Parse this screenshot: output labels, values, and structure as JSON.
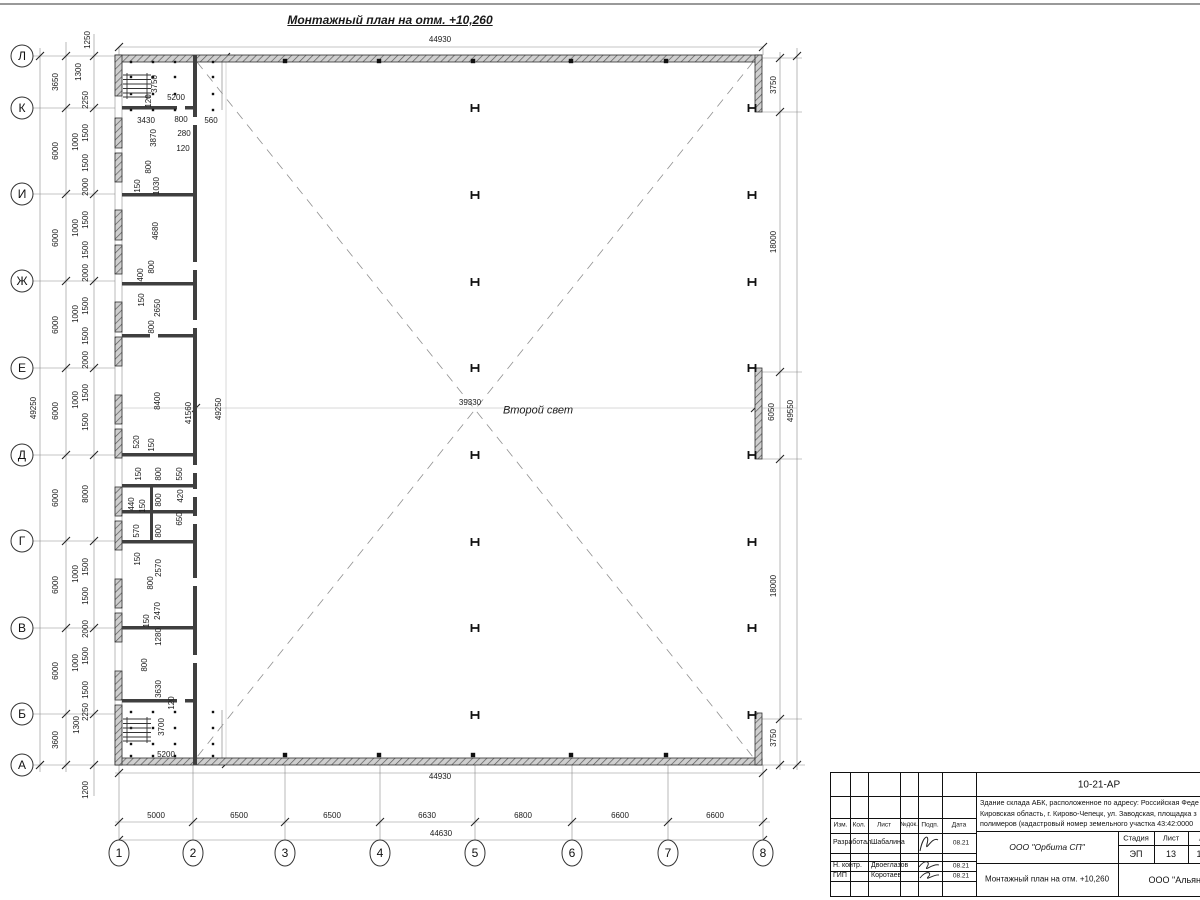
{
  "title": "Монтажный план на отм. +10,260",
  "center_note": "Второй свет",
  "axes": {
    "rows": [
      {
        "label": "Л",
        "y": 56
      },
      {
        "label": "К",
        "y": 108
      },
      {
        "label": "И",
        "y": 194
      },
      {
        "label": "Ж",
        "y": 281
      },
      {
        "label": "Е",
        "y": 368
      },
      {
        "label": "Д",
        "y": 455
      },
      {
        "label": "Г",
        "y": 541
      },
      {
        "label": "В",
        "y": 628
      },
      {
        "label": "Б",
        "y": 714
      },
      {
        "label": "А",
        "y": 765
      }
    ],
    "cols": [
      {
        "label": "1",
        "x": 119
      },
      {
        "label": "2",
        "x": 193
      },
      {
        "label": "3",
        "x": 285
      },
      {
        "label": "4",
        "x": 380
      },
      {
        "label": "5",
        "x": 475
      },
      {
        "label": "6",
        "x": 572
      },
      {
        "label": "7",
        "x": 668
      },
      {
        "label": "8",
        "x": 763
      }
    ]
  },
  "labels": [
    {
      "t": "Монтажный план на отм. +10,260",
      "x": 390,
      "y": 20,
      "fs": 12,
      "i": 1,
      "b": 1,
      "u": 1,
      "n": "drawing-title"
    },
    {
      "t": "44930",
      "x": 440,
      "y": 40
    },
    {
      "t": "44930",
      "x": 440,
      "y": 777
    },
    {
      "t": "44630",
      "x": 441,
      "y": 834
    },
    {
      "t": "5000",
      "x": 156,
      "y": 816
    },
    {
      "t": "6500",
      "x": 239,
      "y": 816
    },
    {
      "t": "6500",
      "x": 332,
      "y": 816
    },
    {
      "t": "6630",
      "x": 427,
      "y": 816
    },
    {
      "t": "6800",
      "x": 523,
      "y": 816
    },
    {
      "t": "6600",
      "x": 620,
      "y": 816
    },
    {
      "t": "6600",
      "x": 715,
      "y": 816
    },
    {
      "t": "3650",
      "x": 56,
      "y": 82,
      "r": 1
    },
    {
      "t": "6000",
      "x": 56,
      "y": 151,
      "r": 1
    },
    {
      "t": "6000",
      "x": 56,
      "y": 238,
      "r": 1
    },
    {
      "t": "6000",
      "x": 56,
      "y": 325,
      "r": 1
    },
    {
      "t": "6000",
      "x": 56,
      "y": 411,
      "r": 1
    },
    {
      "t": "6000",
      "x": 56,
      "y": 498,
      "r": 1
    },
    {
      "t": "6000",
      "x": 56,
      "y": 585,
      "r": 1
    },
    {
      "t": "6000",
      "x": 56,
      "y": 671,
      "r": 1
    },
    {
      "t": "3600",
      "x": 56,
      "y": 740,
      "r": 1
    },
    {
      "t": "49250",
      "x": 34,
      "y": 408,
      "r": 1
    },
    {
      "t": "1250",
      "x": 88,
      "y": 40,
      "r": 1
    },
    {
      "t": "1300",
      "x": 79,
      "y": 72,
      "r": 1
    },
    {
      "t": "2250",
      "x": 86,
      "y": 100,
      "r": 1
    },
    {
      "t": "1500",
      "x": 86,
      "y": 133,
      "r": 1
    },
    {
      "t": "1000",
      "x": 76,
      "y": 142,
      "r": 1
    },
    {
      "t": "1500",
      "x": 86,
      "y": 163,
      "r": 1
    },
    {
      "t": "2000",
      "x": 86,
      "y": 187,
      "r": 1
    },
    {
      "t": "1500",
      "x": 86,
      "y": 220,
      "r": 1
    },
    {
      "t": "1000",
      "x": 76,
      "y": 228,
      "r": 1
    },
    {
      "t": "1500",
      "x": 86,
      "y": 250,
      "r": 1
    },
    {
      "t": "2000",
      "x": 86,
      "y": 273,
      "r": 1
    },
    {
      "t": "1500",
      "x": 86,
      "y": 306,
      "r": 1
    },
    {
      "t": "1000",
      "x": 76,
      "y": 314,
      "r": 1
    },
    {
      "t": "1500",
      "x": 86,
      "y": 336,
      "r": 1
    },
    {
      "t": "2000",
      "x": 86,
      "y": 360,
      "r": 1
    },
    {
      "t": "1500",
      "x": 86,
      "y": 393,
      "r": 1
    },
    {
      "t": "1000",
      "x": 76,
      "y": 400,
      "r": 1
    },
    {
      "t": "1500",
      "x": 86,
      "y": 422,
      "r": 1
    },
    {
      "t": "8000",
      "x": 86,
      "y": 494,
      "r": 1
    },
    {
      "t": "1500",
      "x": 86,
      "y": 567,
      "r": 1
    },
    {
      "t": "1000",
      "x": 76,
      "y": 574,
      "r": 1
    },
    {
      "t": "1500",
      "x": 86,
      "y": 596,
      "r": 1
    },
    {
      "t": "2000",
      "x": 86,
      "y": 629,
      "r": 1
    },
    {
      "t": "1500",
      "x": 86,
      "y": 656,
      "r": 1
    },
    {
      "t": "1000",
      "x": 76,
      "y": 663,
      "r": 1
    },
    {
      "t": "1500",
      "x": 86,
      "y": 690,
      "r": 1
    },
    {
      "t": "2250",
      "x": 86,
      "y": 712,
      "r": 1
    },
    {
      "t": "1300",
      "x": 77,
      "y": 725,
      "r": 1
    },
    {
      "t": "1200",
      "x": 86,
      "y": 790,
      "r": 1
    },
    {
      "t": "3750",
      "x": 155,
      "y": 84,
      "r": 1
    },
    {
      "t": "5200",
      "x": 176,
      "y": 98
    },
    {
      "t": "120",
      "x": 149,
      "y": 101,
      "r": 1
    },
    {
      "t": "3430",
      "x": 146,
      "y": 121
    },
    {
      "t": "800",
      "x": 181,
      "y": 120
    },
    {
      "t": "560",
      "x": 211,
      "y": 121
    },
    {
      "t": "280",
      "x": 184,
      "y": 134
    },
    {
      "t": "120",
      "x": 183,
      "y": 149
    },
    {
      "t": "3870",
      "x": 154,
      "y": 138,
      "r": 1
    },
    {
      "t": "800",
      "x": 149,
      "y": 167,
      "r": 1
    },
    {
      "t": "150",
      "x": 138,
      "y": 186,
      "r": 1
    },
    {
      "t": "1030",
      "x": 157,
      "y": 186,
      "r": 1
    },
    {
      "t": "4680",
      "x": 156,
      "y": 231,
      "r": 1
    },
    {
      "t": "800",
      "x": 152,
      "y": 267,
      "r": 1
    },
    {
      "t": "400",
      "x": 141,
      "y": 275,
      "r": 1
    },
    {
      "t": "150",
      "x": 142,
      "y": 300,
      "r": 1
    },
    {
      "t": "2650",
      "x": 158,
      "y": 308,
      "r": 1
    },
    {
      "t": "800",
      "x": 152,
      "y": 327,
      "r": 1
    },
    {
      "t": "8400",
      "x": 158,
      "y": 401,
      "r": 1
    },
    {
      "t": "41560",
      "x": 189,
      "y": 413,
      "r": 1
    },
    {
      "t": "49250",
      "x": 219,
      "y": 409,
      "r": 1
    },
    {
      "t": "520",
      "x": 137,
      "y": 442,
      "r": 1
    },
    {
      "t": "150",
      "x": 152,
      "y": 445,
      "r": 1
    },
    {
      "t": "150",
      "x": 139,
      "y": 474,
      "r": 1
    },
    {
      "t": "800",
      "x": 159,
      "y": 474,
      "r": 1
    },
    {
      "t": "550",
      "x": 180,
      "y": 474,
      "r": 1
    },
    {
      "t": "440",
      "x": 132,
      "y": 504,
      "r": 1
    },
    {
      "t": "150",
      "x": 143,
      "y": 506,
      "r": 1
    },
    {
      "t": "800",
      "x": 159,
      "y": 500,
      "r": 1
    },
    {
      "t": "420",
      "x": 181,
      "y": 496,
      "r": 1
    },
    {
      "t": "570",
      "x": 137,
      "y": 531,
      "r": 1
    },
    {
      "t": "800",
      "x": 159,
      "y": 531,
      "r": 1
    },
    {
      "t": "650",
      "x": 180,
      "y": 519,
      "r": 1
    },
    {
      "t": "150",
      "x": 138,
      "y": 559,
      "r": 1
    },
    {
      "t": "2570",
      "x": 159,
      "y": 568,
      "r": 1
    },
    {
      "t": "800",
      "x": 151,
      "y": 583,
      "r": 1
    },
    {
      "t": "2470",
      "x": 158,
      "y": 611,
      "r": 1
    },
    {
      "t": "150",
      "x": 147,
      "y": 621,
      "r": 1
    },
    {
      "t": "1280",
      "x": 159,
      "y": 637,
      "r": 1
    },
    {
      "t": "800",
      "x": 145,
      "y": 665,
      "r": 1
    },
    {
      "t": "3630",
      "x": 159,
      "y": 689,
      "r": 1
    },
    {
      "t": "120",
      "x": 172,
      "y": 703,
      "r": 1
    },
    {
      "t": "3700",
      "x": 162,
      "y": 727,
      "r": 1
    },
    {
      "t": "5200",
      "x": 166,
      "y": 755
    },
    {
      "t": "39330",
      "x": 470,
      "y": 403
    },
    {
      "t": "Второй свет",
      "x": 538,
      "y": 411,
      "fs": 11,
      "i": 1,
      "n": "second-light-label"
    },
    {
      "t": "3750",
      "x": 774,
      "y": 85,
      "r": 1
    },
    {
      "t": "18000",
      "x": 774,
      "y": 242,
      "r": 1
    },
    {
      "t": "6050",
      "x": 772,
      "y": 412,
      "r": 1
    },
    {
      "t": "49550",
      "x": 791,
      "y": 411,
      "r": 1
    },
    {
      "t": "18000",
      "x": 774,
      "y": 586,
      "r": 1
    },
    {
      "t": "3750",
      "x": 774,
      "y": 738,
      "r": 1
    }
  ],
  "titleblock": {
    "code": "10-21-АР",
    "address_lines": [
      "Здание склада АБК, расположенное по адресу: Российская Феде",
      "Кировская область, г. Кирово-Чепецк, ул. Заводская, площадка з",
      "полимеров (кадастровый номер земельного участка 43:42:0000"
    ],
    "cols": [
      "Изм.",
      "Кол.",
      "Лист",
      "№док.",
      "Подп.",
      "Дата"
    ],
    "rows": [
      {
        "role": "Разработал",
        "name": "Шабалина",
        "date": "08.21"
      },
      {
        "role": "Н. контр.",
        "name": "Двоеглазов",
        "date": "08.21"
      },
      {
        "role": "ГИП",
        "name": "Коротаев",
        "date": "08.21"
      }
    ],
    "stage_label": "Стадия",
    "sheet_label": "Лист",
    "sheets_label": "Листов",
    "stage": "ЭП",
    "sheet": "13",
    "sheets": "1",
    "org": "ООО \"Орбита СП\"",
    "doc_title": "Монтажный план на отм. +10,260",
    "org2": "ООО \"Альянс"
  }
}
